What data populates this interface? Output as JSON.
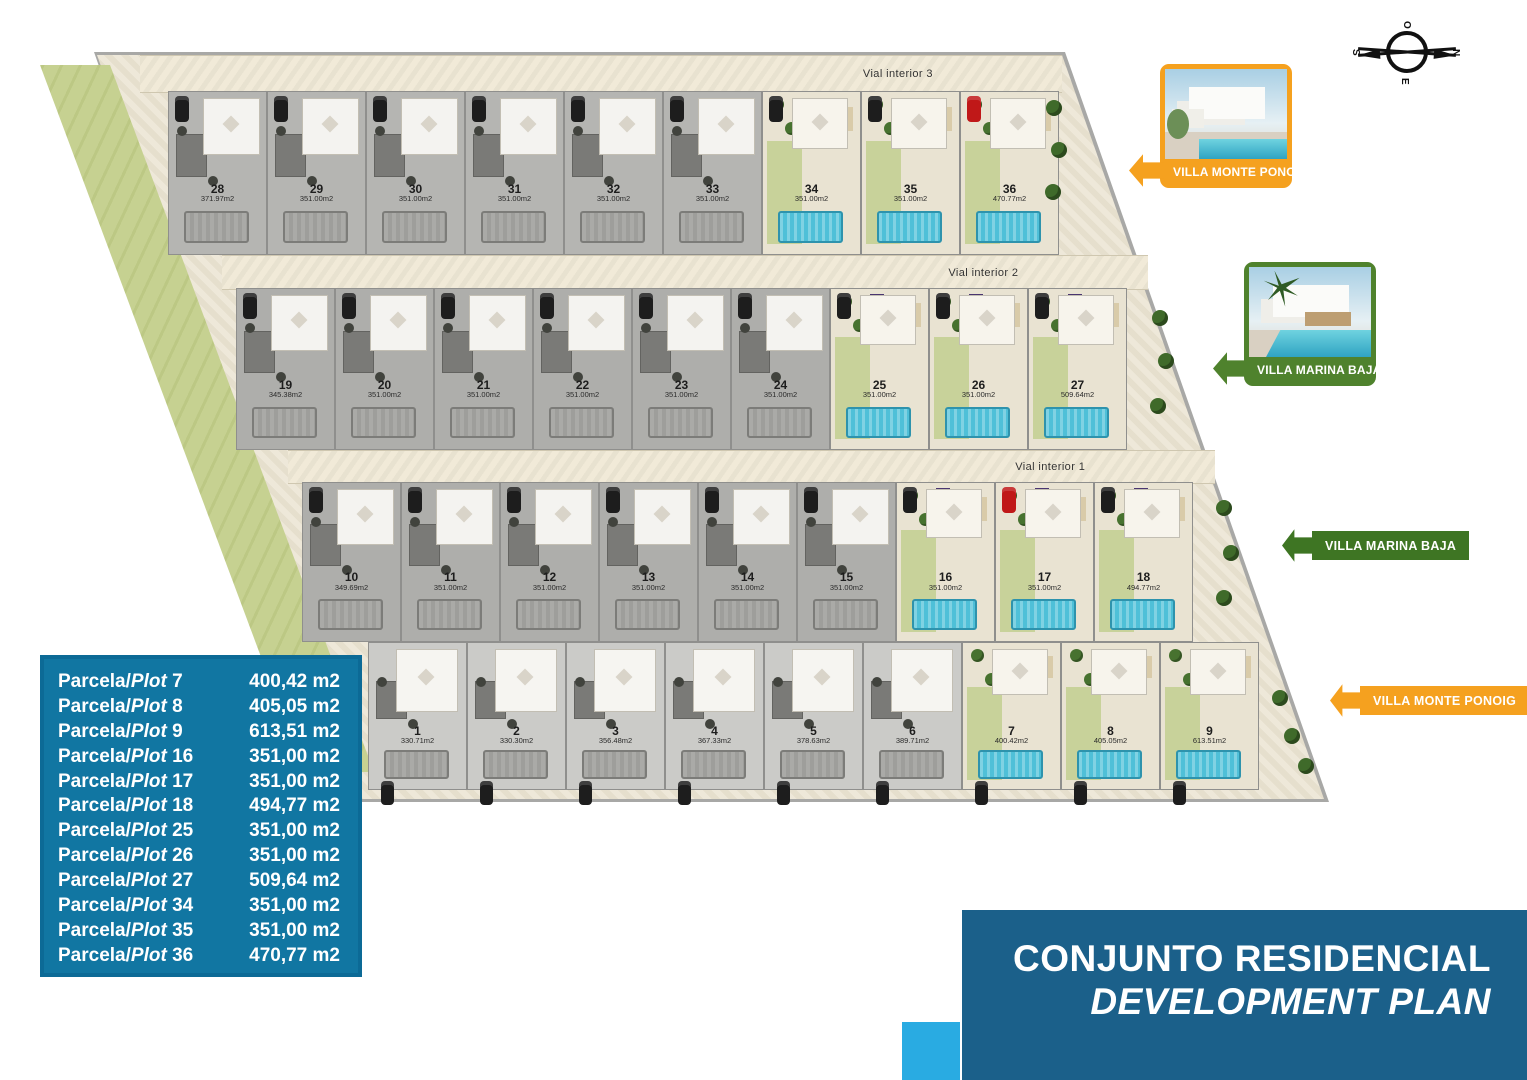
{
  "compass": {
    "top": "O",
    "right": "N",
    "left": "S",
    "bottom": "E"
  },
  "site": {
    "roads": [
      {
        "label": "Vial interior 3"
      },
      {
        "label": "Vial interior 2"
      },
      {
        "label": "Vial interior 1"
      }
    ],
    "rows": [
      {
        "plots": [
          {
            "num": "28",
            "area": "371.97m2",
            "type": "gray"
          },
          {
            "num": "29",
            "area": "351.00m2",
            "type": "gray"
          },
          {
            "num": "30",
            "area": "351.00m2",
            "type": "gray"
          },
          {
            "num": "31",
            "area": "351.00m2",
            "type": "gray"
          },
          {
            "num": "32",
            "area": "351.00m2",
            "type": "gray"
          },
          {
            "num": "33",
            "area": "351.00m2",
            "type": "gray"
          },
          {
            "num": "34",
            "area": "351.00m2",
            "type": "green"
          },
          {
            "num": "35",
            "area": "351.00m2",
            "type": "green"
          },
          {
            "num": "36",
            "area": "470.77m2",
            "type": "green",
            "car": "red"
          }
        ]
      },
      {
        "plots": [
          {
            "num": "19",
            "area": "345.38m2",
            "type": "gray"
          },
          {
            "num": "20",
            "area": "351.00m2",
            "type": "gray"
          },
          {
            "num": "21",
            "area": "351.00m2",
            "type": "gray"
          },
          {
            "num": "22",
            "area": "351.00m2",
            "type": "gray"
          },
          {
            "num": "23",
            "area": "351.00m2",
            "type": "gray"
          },
          {
            "num": "24",
            "area": "351.00m2",
            "type": "gray"
          },
          {
            "num": "25",
            "area": "351.00m2",
            "type": "green",
            "solar": true
          },
          {
            "num": "26",
            "area": "351.00m2",
            "type": "green",
            "solar": true
          },
          {
            "num": "27",
            "area": "509.64m2",
            "type": "green",
            "solar": true
          }
        ]
      },
      {
        "plots": [
          {
            "num": "10",
            "area": "349.69m2",
            "type": "gray"
          },
          {
            "num": "11",
            "area": "351.00m2",
            "type": "gray"
          },
          {
            "num": "12",
            "area": "351.00m2",
            "type": "gray"
          },
          {
            "num": "13",
            "area": "351.00m2",
            "type": "gray"
          },
          {
            "num": "14",
            "area": "351.00m2",
            "type": "gray"
          },
          {
            "num": "15",
            "area": "351.00m2",
            "type": "gray"
          },
          {
            "num": "16",
            "area": "351.00m2",
            "type": "green",
            "solar": true
          },
          {
            "num": "17",
            "area": "351.00m2",
            "type": "green",
            "solar": true,
            "car": "red"
          },
          {
            "num": "18",
            "area": "494.77m2",
            "type": "green",
            "solar": true
          }
        ]
      },
      {
        "plots": [
          {
            "num": "1",
            "area": "330.71m2",
            "type": "light"
          },
          {
            "num": "2",
            "area": "330.30m2",
            "type": "light"
          },
          {
            "num": "3",
            "area": "356.48m2",
            "type": "light"
          },
          {
            "num": "4",
            "area": "367.33m2",
            "type": "light"
          },
          {
            "num": "5",
            "area": "378.63m2",
            "type": "light"
          },
          {
            "num": "6",
            "area": "389.71m2",
            "type": "light"
          },
          {
            "num": "7",
            "area": "400.42m2",
            "type": "green"
          },
          {
            "num": "8",
            "area": "405.05m2",
            "type": "green"
          },
          {
            "num": "9",
            "area": "613.51m2",
            "type": "green"
          }
        ]
      }
    ]
  },
  "legend_cards": [
    {
      "label": "VILLA MONTE PONOIG",
      "theme": "orange"
    },
    {
      "label": "VILLA MARINA BAJA",
      "theme": "green"
    }
  ],
  "arrow_tags": [
    {
      "label": "VILLA MARINA BAJA",
      "theme": "green"
    },
    {
      "label": "VILLA MONTE PONOIG",
      "theme": "orange"
    }
  ],
  "table": {
    "label_prefix": "Parcela/",
    "label_italic": "Plot",
    "rows": [
      {
        "plot": "7",
        "value": "400,42 m2"
      },
      {
        "plot": "8",
        "value": "405,05 m2"
      },
      {
        "plot": "9",
        "value": "613,51 m2"
      },
      {
        "plot": "16",
        "value": "351,00 m2"
      },
      {
        "plot": "17",
        "value": "351,00 m2"
      },
      {
        "plot": "18",
        "value": "494,77 m2"
      },
      {
        "plot": "25",
        "value": "351,00 m2"
      },
      {
        "plot": "26",
        "value": "351,00 m2"
      },
      {
        "plot": "27",
        "value": "509,64 m2"
      },
      {
        "plot": "34",
        "value": "351,00 m2"
      },
      {
        "plot": "35",
        "value": "351,00 m2"
      },
      {
        "plot": "36",
        "value": "470,77 m2"
      }
    ]
  },
  "title_block": {
    "line1": "CONJUNTO RESIDENCIAL",
    "line2": "DEVELOPMENT PLAN"
  },
  "colors": {
    "accent_orange": "#F5A11F",
    "accent_green": "#3E7523",
    "table_blue": "#1176A2",
    "title_blue": "#1B608A",
    "cyan": "#29ABE2"
  }
}
